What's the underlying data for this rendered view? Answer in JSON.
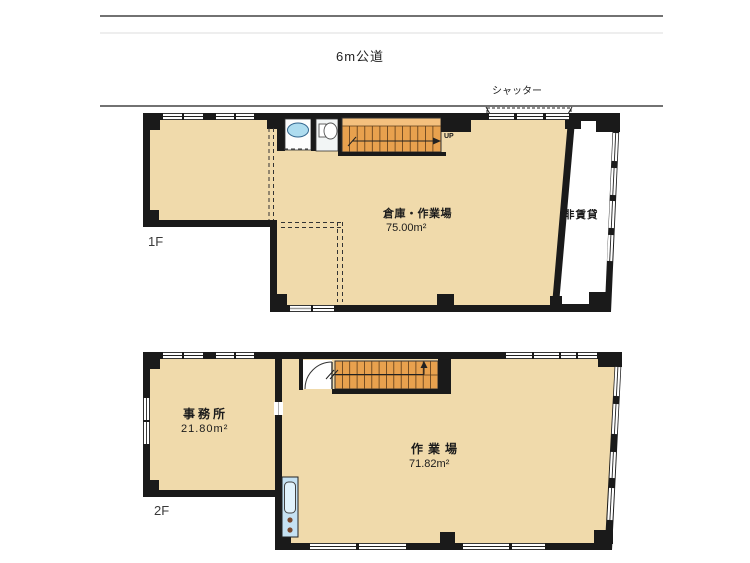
{
  "road": {
    "label": "6m公道"
  },
  "shutter": {
    "label": "シャッター"
  },
  "floor1": {
    "label": "1F",
    "room": {
      "name": "倉庫・作業場",
      "area": "75.00m²"
    },
    "nonrental": {
      "name": "非賃貸"
    },
    "stairs": {
      "direction_label": "UP"
    },
    "fixtures": [
      "sink-icon",
      "toilet-icon",
      "staircase-up"
    ]
  },
  "floor2": {
    "label": "2F",
    "office": {
      "name": "事務所",
      "area": "21.80m²"
    },
    "workshop": {
      "name": "作業場",
      "area": "71.82m²"
    },
    "fixtures": [
      "door-arc",
      "staircase-down",
      "mini-kitchen"
    ]
  },
  "colors": {
    "floor_fill": "#F0DAAB",
    "wall": "#1A1A1A",
    "stairs": "#E8A14E",
    "stairs_light": "#F4C07E",
    "sink_water": "#AEDCEF",
    "kitchen_unit": "#C5E1F2",
    "nonrental_area": "#FFFFFF",
    "road_line": "#444444"
  }
}
